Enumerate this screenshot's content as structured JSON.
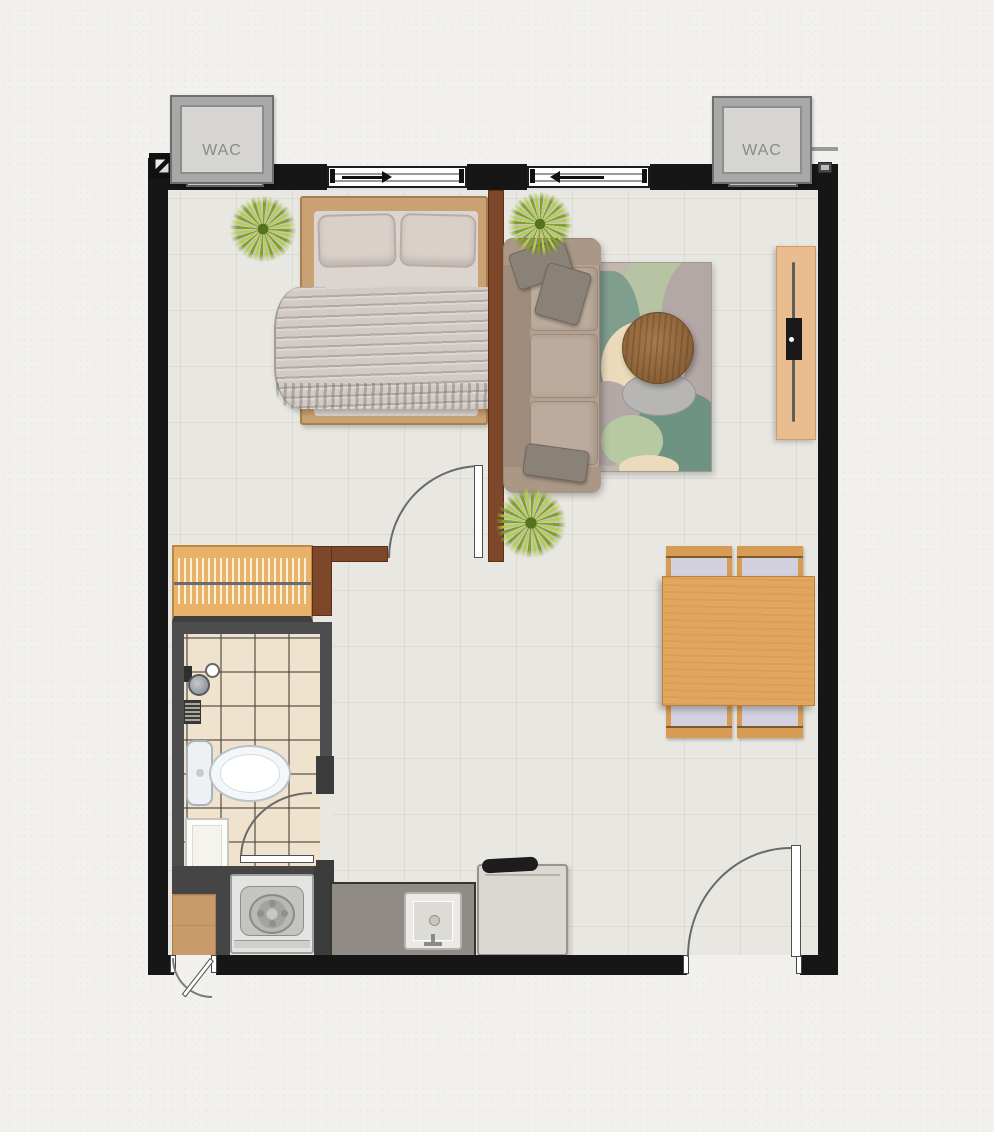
{
  "ac_units": [
    {
      "label": "WAC"
    },
    {
      "label": "WAC"
    }
  ],
  "palette": {
    "wall": "#161616",
    "floor_tile": "#e9e7e2",
    "partition_wood": "#7c4829",
    "closet_wood": "#e8b269",
    "bath_wall": "#4d4d4d",
    "bath_tile": "#f0e3cd",
    "dining_wood": "#e2a75f",
    "sofa": "#b3a08f",
    "rug_base": "#c1b7ad",
    "rug_teal": "#6f9383",
    "rug_sage": "#b6c4a3",
    "counter": "#908b85",
    "plant_green": "#93b32f",
    "wac_label_color": "#8a8a8a"
  },
  "icons": {
    "corner_marker": "diagonal-triangles",
    "window_left_slide": "arrow-right",
    "window_right_slide": "arrow-left",
    "plant": "conic-leaf-burst",
    "door_swing": "quarter-arc"
  }
}
